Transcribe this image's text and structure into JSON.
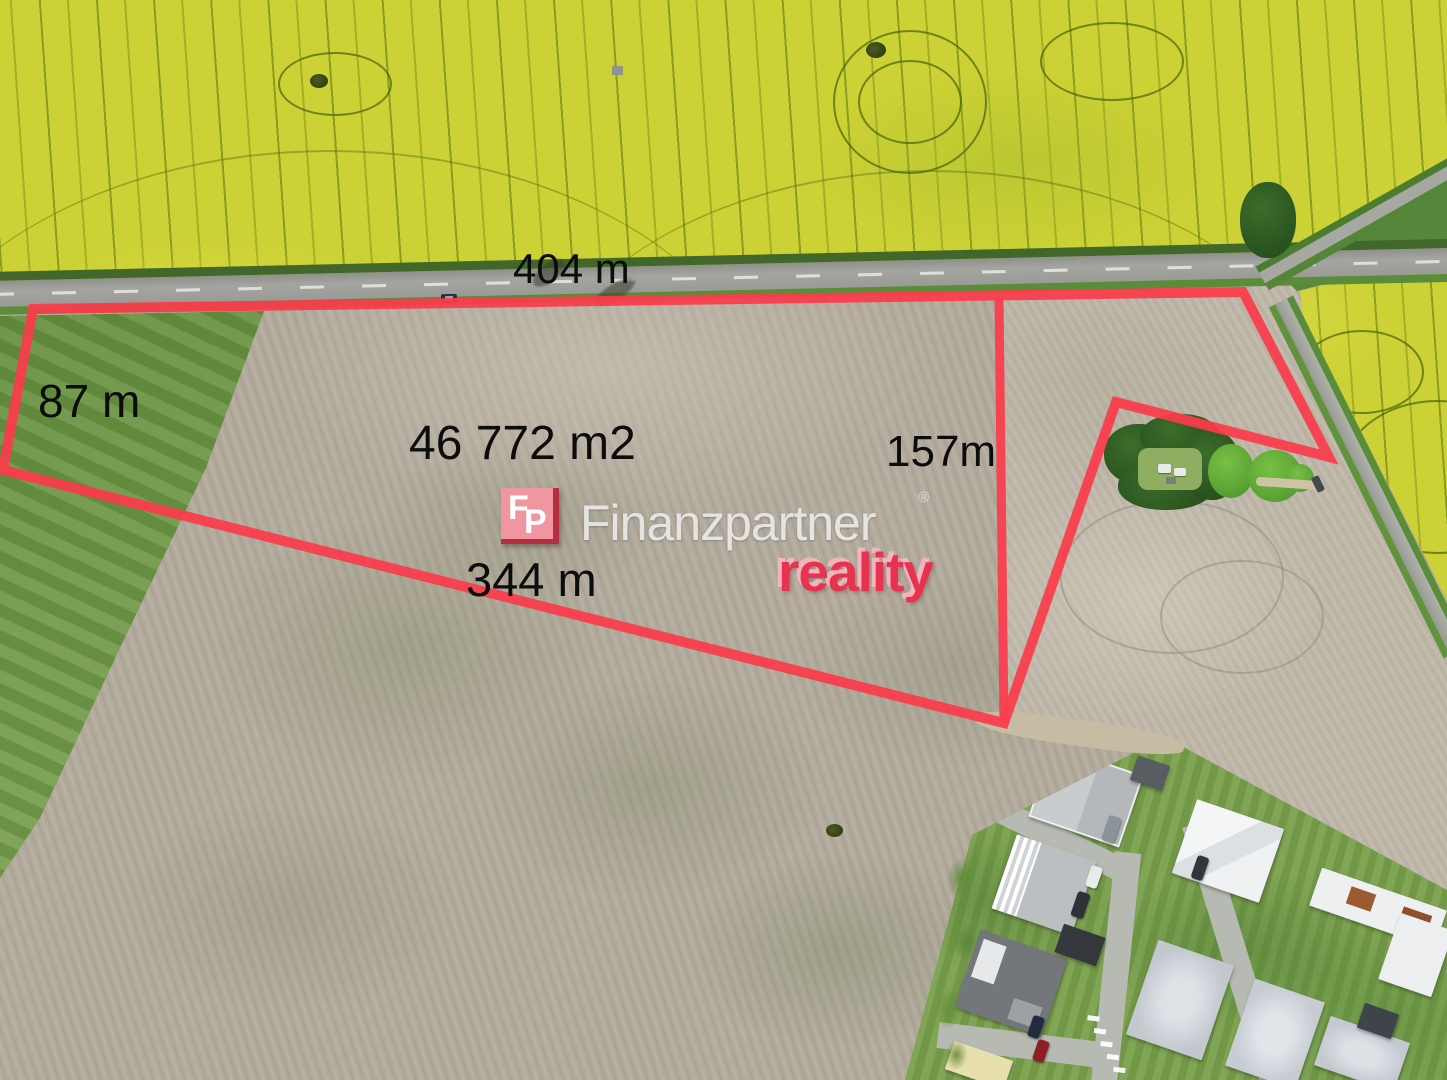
{
  "scene": {
    "description": "aerial drone photo of land plot for sale outlined in red"
  },
  "measurements": {
    "north": "404 m",
    "west": "87 m",
    "area": "46 772 m2",
    "east": "157m",
    "south": "344 m"
  },
  "watermark": {
    "monogram_f": "F",
    "monogram_p": "P",
    "brand": "Finanzpartner",
    "registered": "®",
    "division": "reality"
  },
  "colors": {
    "boundary_red": "#fb3b4b",
    "brand_pink": "#ef96a0",
    "brand_dark_red": "#b43040",
    "reality_red": "#e73250",
    "rapeseed_yellow": "#ccd135",
    "plowed_field": "#b2aa9c",
    "grass_green": "#6f9a42"
  }
}
